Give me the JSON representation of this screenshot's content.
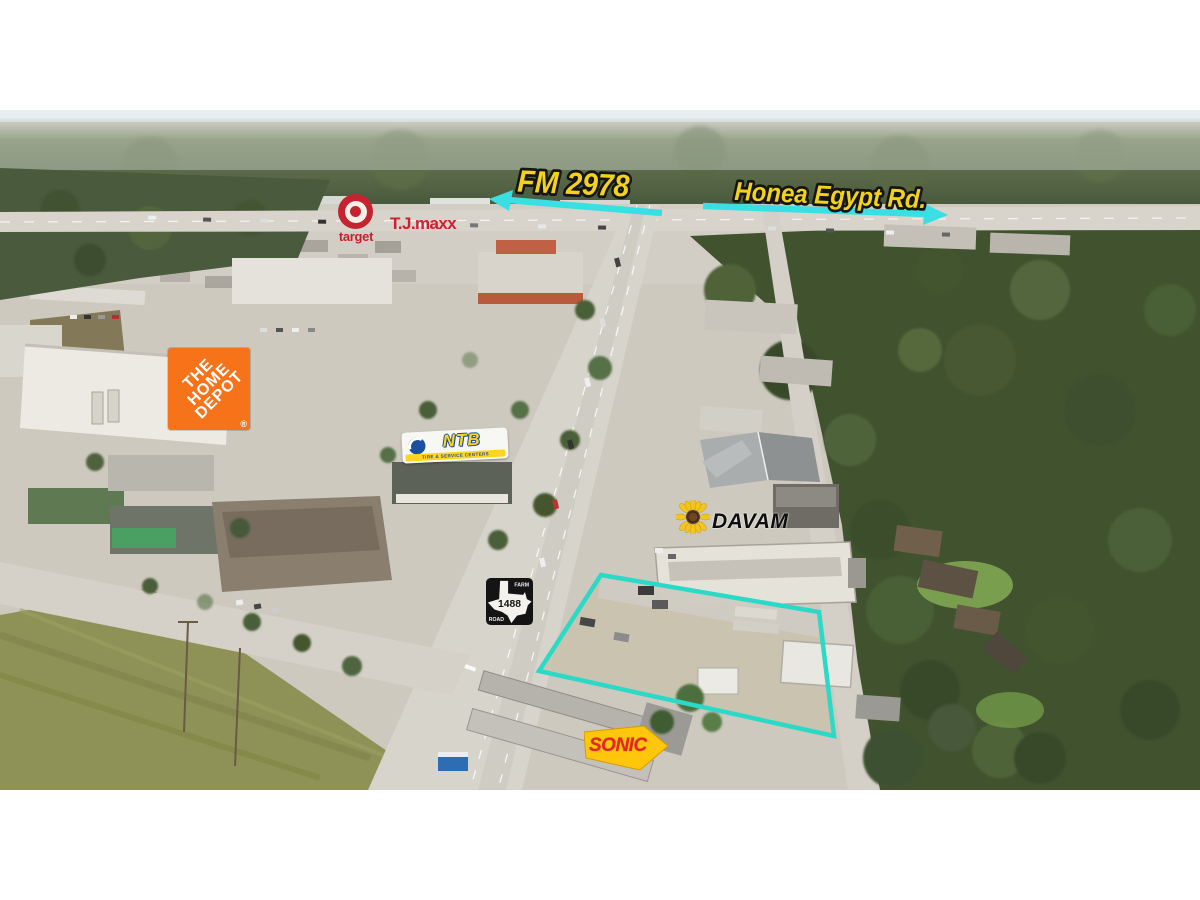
{
  "annotations": {
    "fm2978": {
      "label": "FM 2978"
    },
    "honea": {
      "label": "Honea Egypt Rd."
    },
    "label_color": "#f2d21c",
    "arrow_color": "#39dfe2",
    "property_outline_color": "#2bd9c6"
  },
  "logos": {
    "target": {
      "wordmark": "target",
      "color": "#c4232f"
    },
    "tjmaxx": {
      "wordmark": "T.J.maxx",
      "color": "#cf2030"
    },
    "home_depot": {
      "line1": "THE",
      "line2": "HOME",
      "line3": "DEPOT",
      "reg": "®",
      "color": "#f6731a"
    },
    "ntb": {
      "wordmark": "NTB",
      "tagline": "TIRE & SERVICE CENTERS",
      "yellow": "#ffd51e",
      "blue": "#1c4f9f"
    },
    "davam": {
      "wordmark": "DAVAM"
    },
    "sonic": {
      "wordmark": "SONIC",
      "red": "#e3262c",
      "yellow": "#ffc60b"
    },
    "fm1488_shield": {
      "route": "1488",
      "word_top": "FARM",
      "word_bottom": "ROAD"
    }
  }
}
